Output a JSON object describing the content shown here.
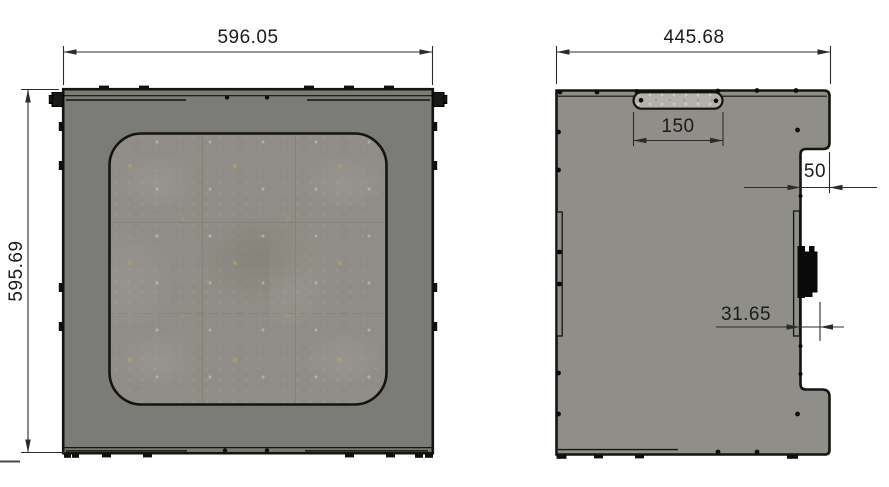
{
  "drawing": {
    "type": "cad-2d-orthographic-views",
    "background_color": "#ffffff",
    "outline_color": "#15150f",
    "dimension_line_color": "#2b2b2b",
    "front_view": {
      "description": "front panel with mesh window",
      "width_dim": "596.05",
      "height_dim": "595.69",
      "body_color": "#7b7b77",
      "window_color": "#8f8d85"
    },
    "side_view": {
      "description": "side panel with handle slot, notch and connector",
      "width_dim": "445.68",
      "handle_slot_dim": "150",
      "notch_depth_dim": "50",
      "connector_offset_dim": "31.65",
      "body_color": "#8f8e88",
      "slot_color": "#b3b1a9",
      "connector_color": "#0a0a0a"
    }
  }
}
